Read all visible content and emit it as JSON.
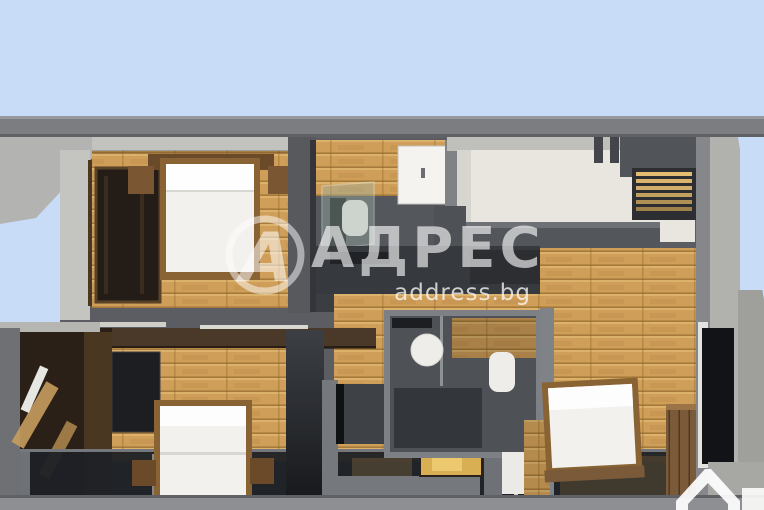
{
  "image": {
    "kind": "3d-floorplan-cutaway-render",
    "description": "Top-down cutaway 3D render of a two-bedroom apartment with two bathrooms, wooden floors and a left balcony",
    "width": 764,
    "height": 510
  },
  "watermark": {
    "logo_letter": "А",
    "brand": "АДРЕС",
    "domain": "address.bg"
  },
  "branding": {
    "circle_logo": "adres-circle-a-logo",
    "corner_logo": "address-bg-house-logo"
  },
  "colors": {
    "sky": "#c9dcf7",
    "beam": "#7b7d80",
    "wallLight": "#b3b4b2",
    "wallMid": "#85878b",
    "wallDark": "#4a4c50",
    "cream": "#e8e6df",
    "wood": "#cf9e58",
    "woodDark": "#7a5a38",
    "brownDark": "#4a3828",
    "tile": "#54575c",
    "glassDark": "#1e2126",
    "furnitureWhite": "#f2f1ed",
    "gold": "#d9af53",
    "watermark": "#ffffff"
  }
}
